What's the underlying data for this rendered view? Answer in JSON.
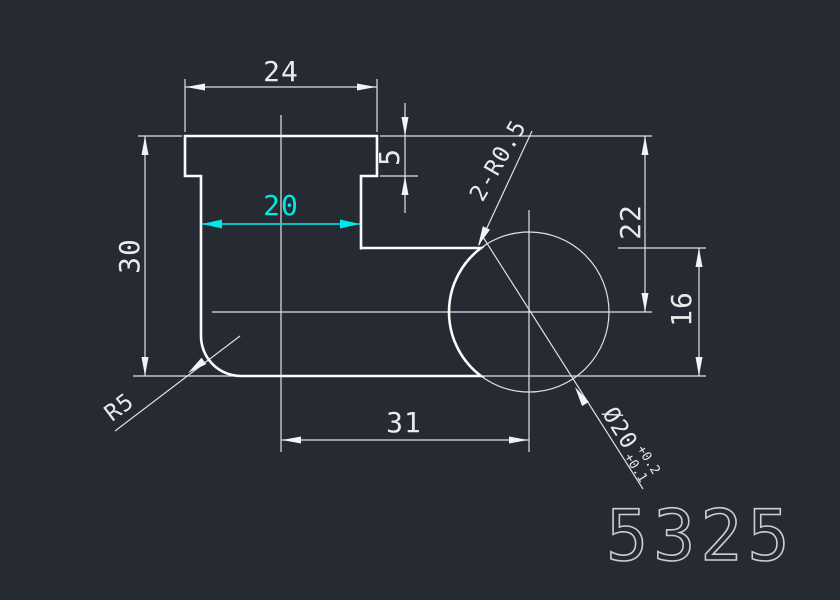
{
  "drawing": {
    "part_number": "5325",
    "colors": {
      "background": "#262a32",
      "lines": "#f2f3f4",
      "highlight": "#00e9e9"
    },
    "dimensions": {
      "top_width": "24",
      "step_height": "5",
      "body_width": "20",
      "total_height": "30",
      "center_from_top": "22",
      "step_to_bottom": "16",
      "center_offset": "31",
      "fillet_radius": "R5",
      "corner_fillets": "2-R0.5",
      "bore_diameter": "Ø20",
      "bore_tol_upper": "+0.2",
      "bore_tol_lower": "+0.1"
    }
  }
}
